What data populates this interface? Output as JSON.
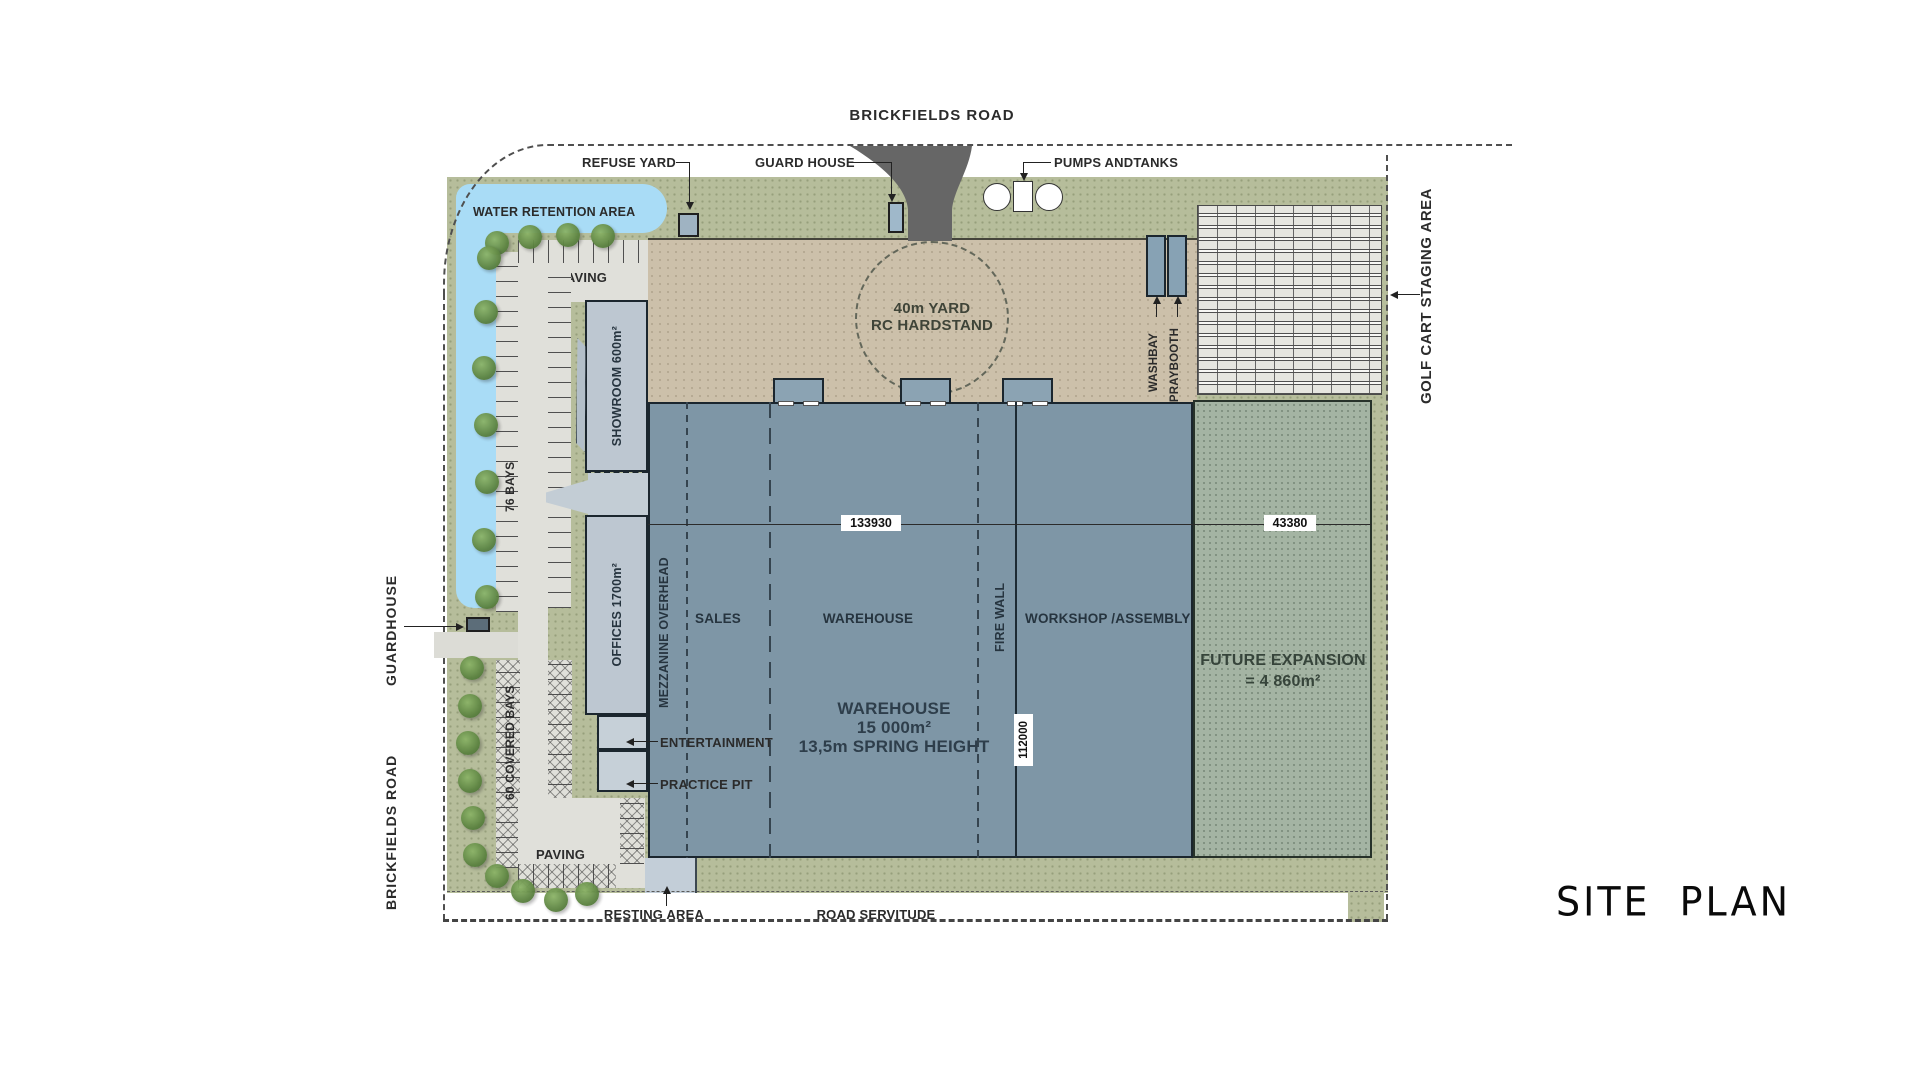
{
  "title": "SITE PLAN",
  "roads": {
    "top": "BRICKFIELDS ROAD",
    "left": "BRICKFIELDS ROAD",
    "servitude": "ROAD SERVITUDE"
  },
  "site": {
    "water_retention": "WATER RETENTION AREA",
    "refuse_yard": "REFUSE YARD",
    "guard_house_top": "GUARD HOUSE",
    "pumps_tanks": "PUMPS ANDTANKS",
    "guardhouse_left": "GUARDHOUSE",
    "paving_top": "PAVING",
    "paving_bottom": "PAVING",
    "bays_76": "76 BAYS",
    "covered_bays_60": "60 COVERED BAYS",
    "resting_area": "RESTING AREA",
    "golf_cart": "GOLF CART STAGING AREA"
  },
  "yard": {
    "line1": "40m YARD",
    "line2": "RC HARDSTAND",
    "washbay": "WASHBAY",
    "spraybooth": "SPRAYBOOTH"
  },
  "buildings": {
    "showroom": "SHOWROOM 600m²",
    "offices": "OFFICES 1700m²",
    "entertainment": "ENTERTAINMENT",
    "practice_pit": "PRACTICE PIT",
    "mezzanine": "MEZZANINE OVERHEAD",
    "sales": "SALES",
    "warehouse_zone": "WAREHOUSE",
    "fire_wall": "FIRE WALL",
    "workshop": "WORKSHOP /ASSEMBLY",
    "warehouse_line1": "WAREHOUSE",
    "warehouse_line2": "15 000m²",
    "warehouse_line3": "13,5m SPRING HEIGHT",
    "future_line1": "FUTURE EXPANSION",
    "future_line2": "= 4 860m²"
  },
  "dimensions": {
    "width_main": "133930",
    "width_expansion": "43380",
    "depth": "112000"
  },
  "colors": {
    "site_green": "#b6bd9b",
    "expansion_green": "#a4b4a3",
    "water_blue": "#a9dcf6",
    "yard_tan": "#ccc0aa",
    "warehouse_blue": "#7e96a6",
    "light_building": "#bdc7d1",
    "road_dark": "#666666",
    "paving_grey": "#e0e0da"
  }
}
